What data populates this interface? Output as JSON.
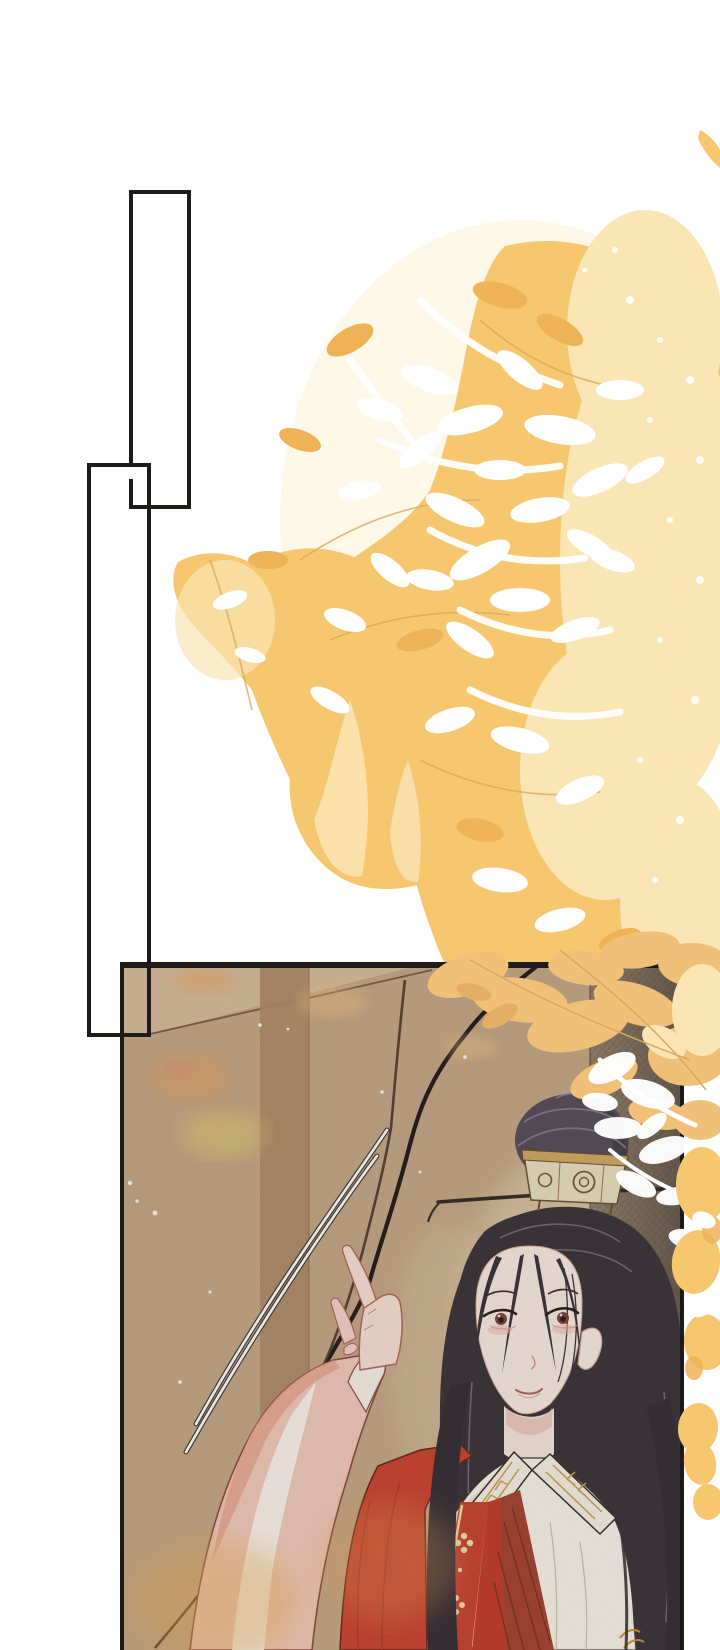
{
  "scene": {
    "type": "webtoon-comic-page",
    "elements": [
      "empty-panel-tall",
      "empty-panel-small",
      "golden-foliage",
      "scene-panel",
      "character"
    ]
  },
  "colors": {
    "page_bg": "#ffffff",
    "panel_line": "#1d1a17",
    "foliage_gold": "#f6c76e",
    "foliage_gold_deep": "#eeb257",
    "foliage_pale": "#fae5b5",
    "foliage_cream": "#fdf3d9",
    "wall_tan": "#c6a988",
    "wall_lit": "#d8bd9c",
    "wall_pillar": "#b18e6d",
    "wall_cream": "#e3cfae",
    "band_dark": "#8b7a6a",
    "band_darker": "#6c5d50",
    "wall_line": "#6e5339",
    "deep_line": "#29211d",
    "hair_dark": "#3f383d",
    "hair_soft": "#5a525c",
    "hair_sheen": "#8f8591",
    "ornament_cream": "#ebdfc2",
    "ornament_gold": "#d3ac65",
    "ornament_line": "#6f5338",
    "gold_trim": "#c9a254",
    "skin": "#f8eae1",
    "skin_line": "#c07b67",
    "blush": "#f0b9ad",
    "iris_brown": "#7b4a42",
    "lip": "#cf938a",
    "robe_red": "#cc4734",
    "robe_red_deep": "#a84836",
    "robe_red_line": "#6b2a1e",
    "robe_white": "#f8f3ea",
    "robe_white_shadow": "#e9ddcc",
    "trim_cream": "#f2dfae",
    "sleeve_pink": "#f2cbbc",
    "sleeve_sheen": "#fbf2eb",
    "sleeve_shadow": "#eba894",
    "glow_orange": "#f0a45c",
    "glow_yellow": "#e8cf6e"
  }
}
